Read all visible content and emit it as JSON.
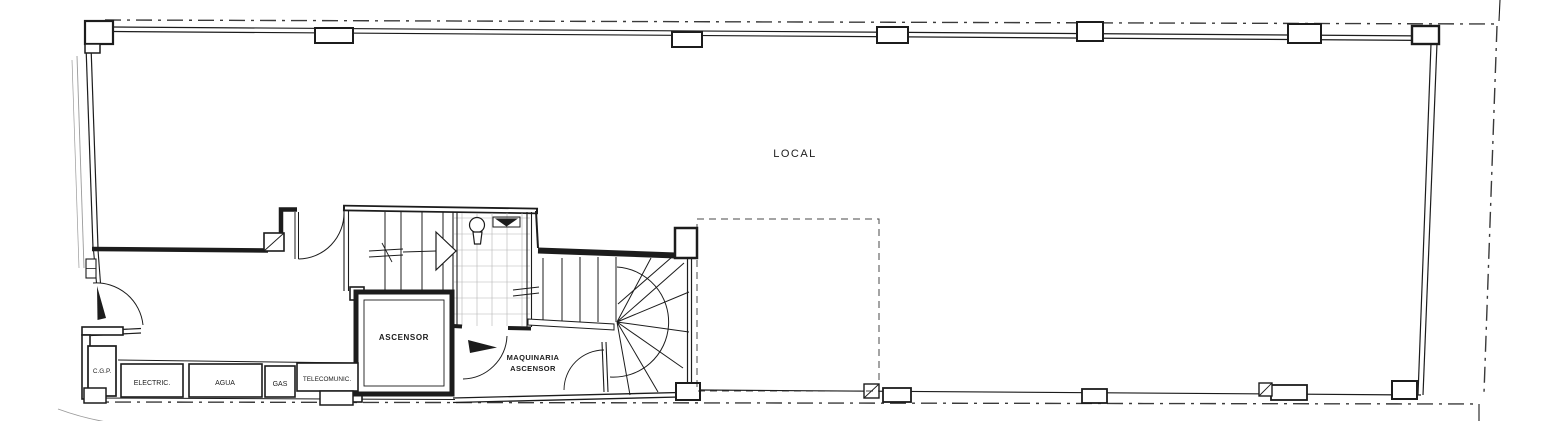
{
  "colors": {
    "paper": "#ffffff",
    "ink": "#1c1c1c",
    "faint": "#9a9a9a",
    "grid": "#b4b4b4",
    "boundary": "#3a3a3a"
  },
  "rooms": {
    "local": {
      "label": "LOCAL"
    },
    "ascensor": {
      "label": "ASCENSOR"
    },
    "maquinaria": {
      "label_line1": "MAQUINARIA",
      "label_line2": "ASCENSOR"
    }
  },
  "utility_boxes": {
    "cgp": {
      "label": "C.G.P."
    },
    "electric": {
      "label": "ELECTRIC."
    },
    "agua": {
      "label": "AGUA"
    },
    "gas": {
      "label": "GAS"
    },
    "telecomunic": {
      "label": "TELECOMUNIC."
    }
  }
}
